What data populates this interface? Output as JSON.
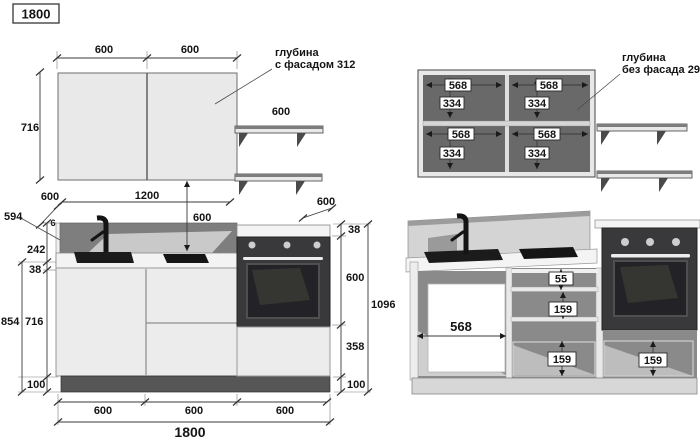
{
  "page": {
    "title": "1800"
  },
  "wall_cabinet_front": {
    "dim_door_left": "600",
    "dim_door_right": "600",
    "dim_height": "716",
    "dim_shelf_width": "600",
    "note_line1": "глубина",
    "note_line2": "с фасадом 312"
  },
  "wall_cabinet_open": {
    "note_line1": "глубина",
    "note_line2": "без фасада 296",
    "cells": [
      {
        "width": "568",
        "height": "334"
      },
      {
        "width": "568",
        "height": "334"
      },
      {
        "width": "568",
        "height": "334"
      },
      {
        "width": "568",
        "height": "334"
      }
    ]
  },
  "base_run_front": {
    "dim_depth_top": "600",
    "dim_wall_span": "1200",
    "dim_wall_to_counter": "600",
    "dim_cooker_width": "600",
    "dim_counter_thickness_right": "38",
    "dim_oven_height": "600",
    "dim_under_oven": "358",
    "dim_plinth_right": "100",
    "dim_total_height": "1096",
    "dim_worktop_depth": "594",
    "dim_gap": "6",
    "dim_backsplash_height": "242",
    "dim_counter_thickness_left": "38",
    "dim_base_height_total": "854",
    "dim_cabinet_height": "716",
    "dim_plinth_left": "100",
    "dim_bottom_1": "600",
    "dim_bottom_2": "600",
    "dim_bottom_3": "600",
    "dim_total_width": "1800"
  },
  "base_run_open": {
    "dim_cabinet_inner_width": "568",
    "dim_drawer_top": "55",
    "dim_drawer_mid": "159",
    "dim_drawer_bottom": "159",
    "dim_drawer_under_oven": "159"
  }
}
